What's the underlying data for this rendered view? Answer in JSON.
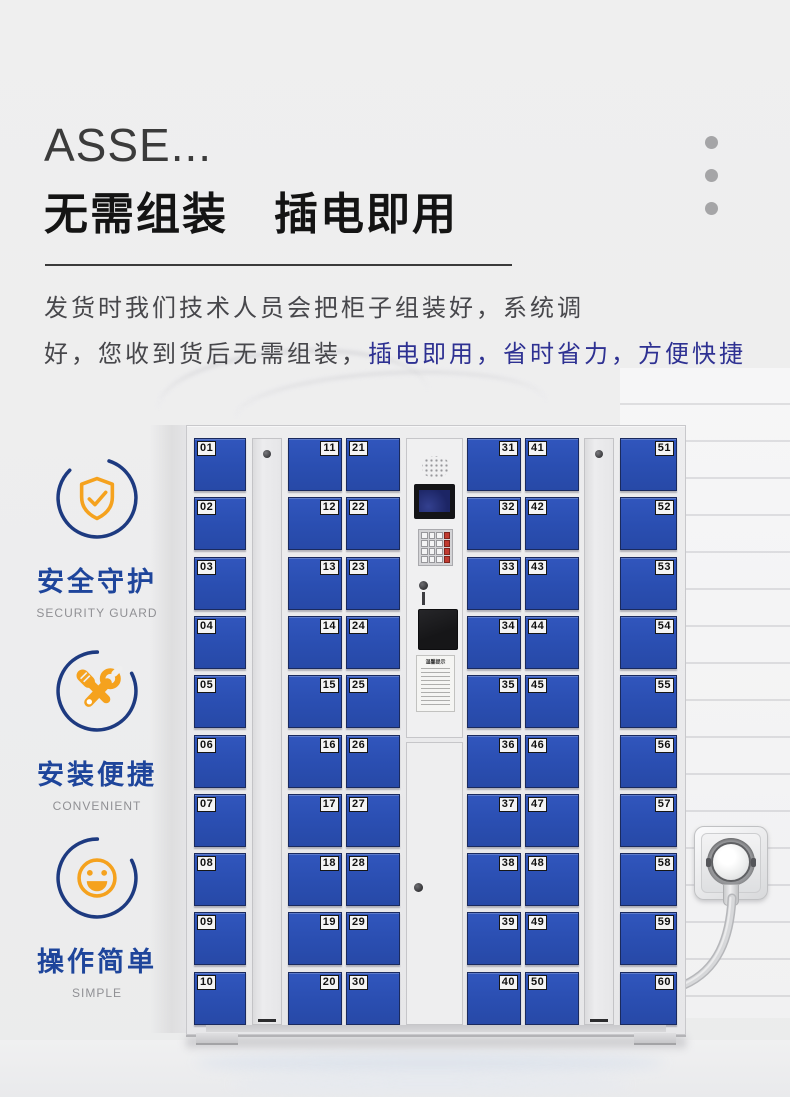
{
  "header": {
    "title": "ASSE...",
    "headline": "无需组装　插电即用",
    "paragraph_line1": "发货时我们技术人员会把柜子组装好，系统调",
    "paragraph_line2_dark": "好，您收到货后无需组装，",
    "paragraph_line2_blue": "插电即用，省时省力，方便快捷"
  },
  "features": [
    {
      "icon": "shield-check-icon",
      "label": "安全守护",
      "sublabel": "SECURITY GUARD"
    },
    {
      "icon": "tools-icon",
      "label": "安装便捷",
      "sublabel": "CONVENIENT"
    },
    {
      "icon": "smiley-icon",
      "label": "操作简单",
      "sublabel": "SIMPLE"
    }
  ],
  "locker": {
    "door_columns": [
      {
        "numbers": [
          "01",
          "02",
          "03",
          "04",
          "05",
          "06",
          "07",
          "08",
          "09",
          "10"
        ],
        "label_side": "left"
      },
      {
        "numbers": [
          "11",
          "12",
          "13",
          "14",
          "15",
          "16",
          "17",
          "18",
          "19",
          "20"
        ],
        "label_side": "right"
      },
      {
        "numbers": [
          "21",
          "22",
          "23",
          "24",
          "25",
          "26",
          "27",
          "28",
          "29",
          "30"
        ],
        "label_side": "left"
      },
      {
        "numbers": [
          "31",
          "32",
          "33",
          "34",
          "35",
          "36",
          "37",
          "38",
          "39",
          "40"
        ],
        "label_side": "right"
      },
      {
        "numbers": [
          "41",
          "42",
          "43",
          "44",
          "45",
          "46",
          "47",
          "48",
          "49",
          "50"
        ],
        "label_side": "left"
      },
      {
        "numbers": [
          "51",
          "52",
          "53",
          "54",
          "55",
          "56",
          "57",
          "58",
          "59",
          "60"
        ],
        "label_side": "right"
      }
    ],
    "control_panel": {
      "sticker_title": "温馨提示"
    }
  },
  "colors": {
    "accent_blue_text": "#2e3192",
    "feature_label_blue": "#1e459b",
    "icon_circle_navy": "#1d3a80",
    "icon_orange": "#f5a21e",
    "door_blue": "#2b50b3",
    "page_background": "#ededee"
  }
}
